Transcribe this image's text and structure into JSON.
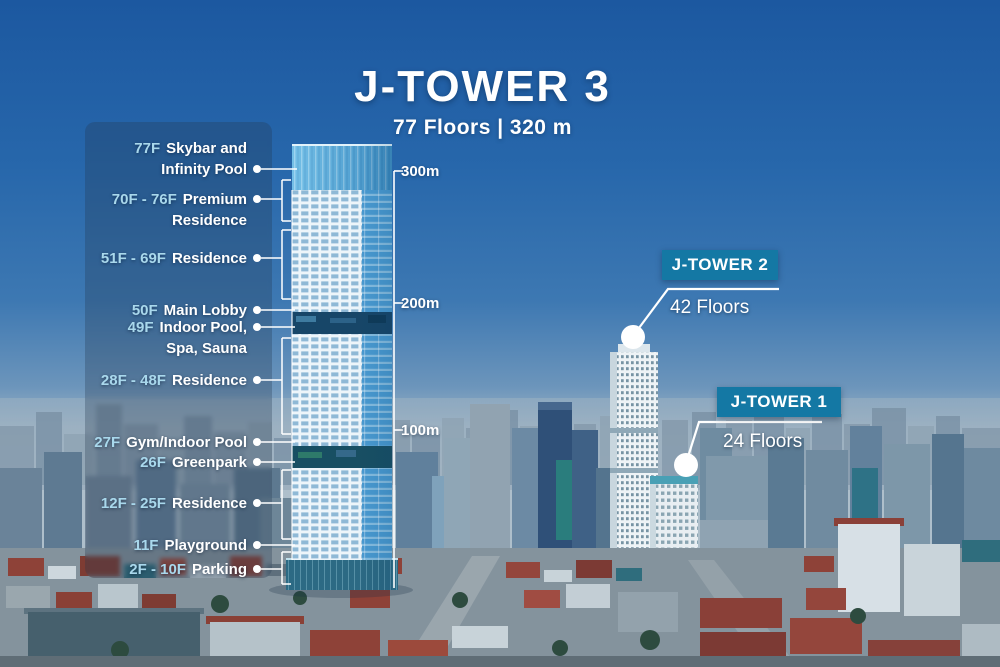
{
  "header": {
    "title": "J-TOWER 3",
    "subtitle": "77 Floors | 320 m"
  },
  "annotations": [
    {
      "floors": "77F",
      "label": "Skybar and\nInfinity Pool"
    },
    {
      "floors": "70F - 76F",
      "label": "Premium\nResidence"
    },
    {
      "floors": "51F - 69F",
      "label": "Residence"
    },
    {
      "floors": "50F",
      "label": "Main Lobby"
    },
    {
      "floors": "49F",
      "label": "Indoor Pool,\nSpa, Sauna"
    },
    {
      "floors": "28F - 48F",
      "label": "Residence"
    },
    {
      "floors": "27F",
      "label": "Gym/Indoor Pool"
    },
    {
      "floors": "26F",
      "label": "Greenpark"
    },
    {
      "floors": "12F - 25F",
      "label": "Residence"
    },
    {
      "floors": "11F",
      "label": "Playground"
    },
    {
      "floors": "2F - 10F",
      "label": "Parking"
    }
  ],
  "height_markers": [
    {
      "label": "300m"
    },
    {
      "label": "200m"
    },
    {
      "label": "100m"
    }
  ],
  "callouts": [
    {
      "name": "J-TOWER 2",
      "floors": "42 Floors"
    },
    {
      "name": "J-TOWER 1",
      "floors": "24 Floors"
    }
  ],
  "colors": {
    "badge_bg": "#1478a4",
    "floor_number_text": "#a9d8ec",
    "sky_top": "#1c58a0"
  }
}
